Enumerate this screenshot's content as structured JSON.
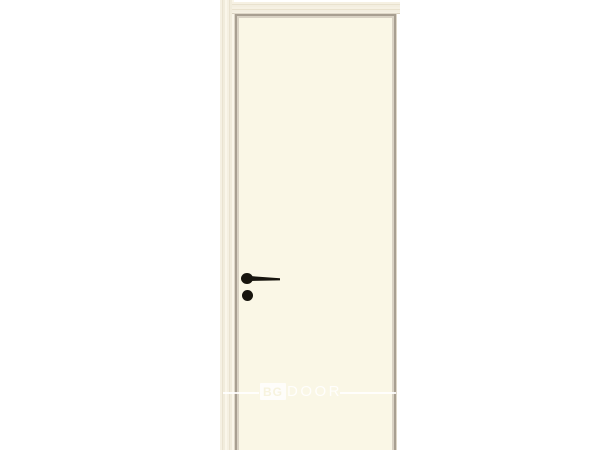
{
  "photo": {
    "subject": "flush interior door with wood frame",
    "background_color": "#FFFFFF"
  },
  "door": {
    "leaf_color": "#FAF7E6",
    "frame_wood_color": "#F1ECDC",
    "edge_trim_color": "#A89F91",
    "hardware_color": "#17150E",
    "hardware": {
      "handle_type": "lever-handle",
      "lock_type": "round-knob-lock"
    }
  },
  "watermark": {
    "logo_text": "BG",
    "brand_text": "DOOR"
  }
}
